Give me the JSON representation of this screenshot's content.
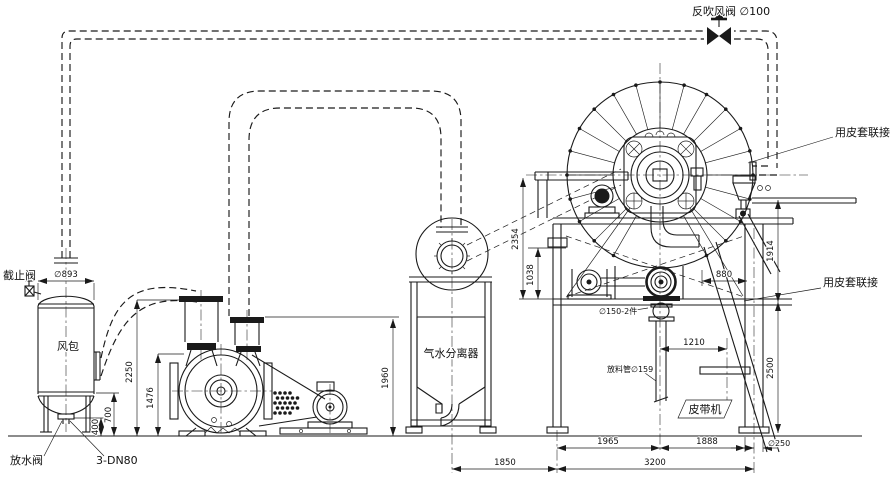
{
  "drawing": {
    "labels": {
      "blowback_valve": "反吹风阀 ∅100",
      "sleeve_coupling_top": "用皮套联接",
      "sleeve_coupling_bottom": "用皮套联接",
      "stop_valve": "截止阀",
      "air_tank": "风包",
      "drain_valve": "放水阀",
      "drain_spec": "3-DN80",
      "separator": "气水分离器",
      "discharge_port": "∅150-2件",
      "discharge_pipe": "放料管∅159",
      "belt_conveyor": "皮带机"
    },
    "dims": {
      "tank_diameter": "∅893",
      "inlet_height": "2250",
      "suction_height": "1476",
      "drain_height": "400",
      "tank_clearance": "700",
      "separator_height": "1960",
      "separator_span": "1850",
      "drum_axis_height": "2354",
      "platform_height": "1038",
      "rear_offset": "880",
      "discharge_offset": "1210",
      "upper_frame_height": "1914",
      "lower_frame_height": "2500",
      "left_span": "1965",
      "right_span": "1888",
      "total_span": "3200",
      "leg_diameter": "∅250"
    },
    "colors": {
      "line": "#1a1a1a",
      "background": "#ffffff"
    }
  }
}
